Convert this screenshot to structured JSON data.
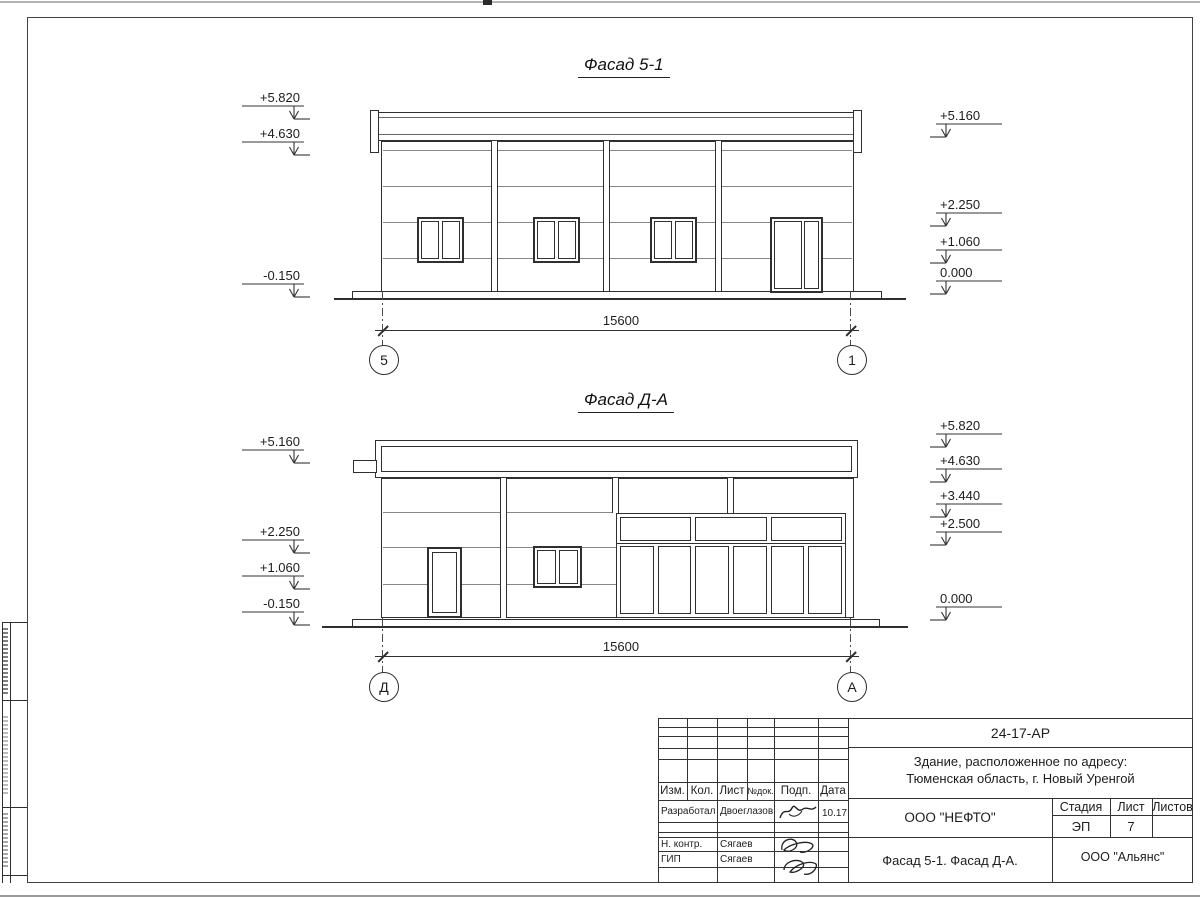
{
  "sheet": {
    "facade1": {
      "title": "Фасад 5-1",
      "dimension_label": "15600",
      "axis_left": "5",
      "axis_right": "1",
      "marks_left": [
        {
          "value": "+5.820",
          "y": 90
        },
        {
          "value": "+4.630",
          "y": 126
        },
        {
          "value": "-0.150",
          "y": 268
        }
      ],
      "marks_right": [
        {
          "value": "+5.160",
          "y": 108
        },
        {
          "value": "+2.250",
          "y": 197
        },
        {
          "value": "+1.060",
          "y": 234
        },
        {
          "value": "0.000",
          "y": 265
        }
      ]
    },
    "facade2": {
      "title": "Фасад Д-А",
      "dimension_label": "15600",
      "axis_left": "Д",
      "axis_right": "А",
      "marks_left": [
        {
          "value": "+5.160",
          "y": 434
        },
        {
          "value": "+2.250",
          "y": 524
        },
        {
          "value": "+1.060",
          "y": 560
        },
        {
          "value": "-0.150",
          "y": 596
        }
      ],
      "marks_right": [
        {
          "value": "+5.820",
          "y": 418
        },
        {
          "value": "+4.630",
          "y": 453
        },
        {
          "value": "+3.440",
          "y": 488
        },
        {
          "value": "+2.500",
          "y": 516
        },
        {
          "value": "0.000",
          "y": 591
        }
      ]
    },
    "title_block": {
      "doc_number": "24-17-АР",
      "object_line1": "Здание, расположенное по адресу:",
      "object_line2": "Тюменская область, г. Новый Уренгой",
      "columns": [
        "Изм.",
        "Кол.",
        "Лист",
        "№док.",
        "Подп.",
        "Дата"
      ],
      "rows": [
        {
          "role": "Разработал",
          "name": "Двоеглазов",
          "date": "10.17"
        },
        {
          "role": "Н. контр.",
          "name": "Сягаев",
          "date": ""
        },
        {
          "role": "ГИП",
          "name": "Сягаев",
          "date": ""
        }
      ],
      "company": "ООО \"НЕФТО\"",
      "stage_label": "Стадия",
      "sheet_label": "Лист",
      "sheets_label": "Листов",
      "stage_value": "ЭП",
      "sheet_value": "7",
      "sheets_value": "",
      "sheet_title": "Фасад 5-1. Фасад Д-А.",
      "firm": "ООО \"Альянс\""
    }
  }
}
